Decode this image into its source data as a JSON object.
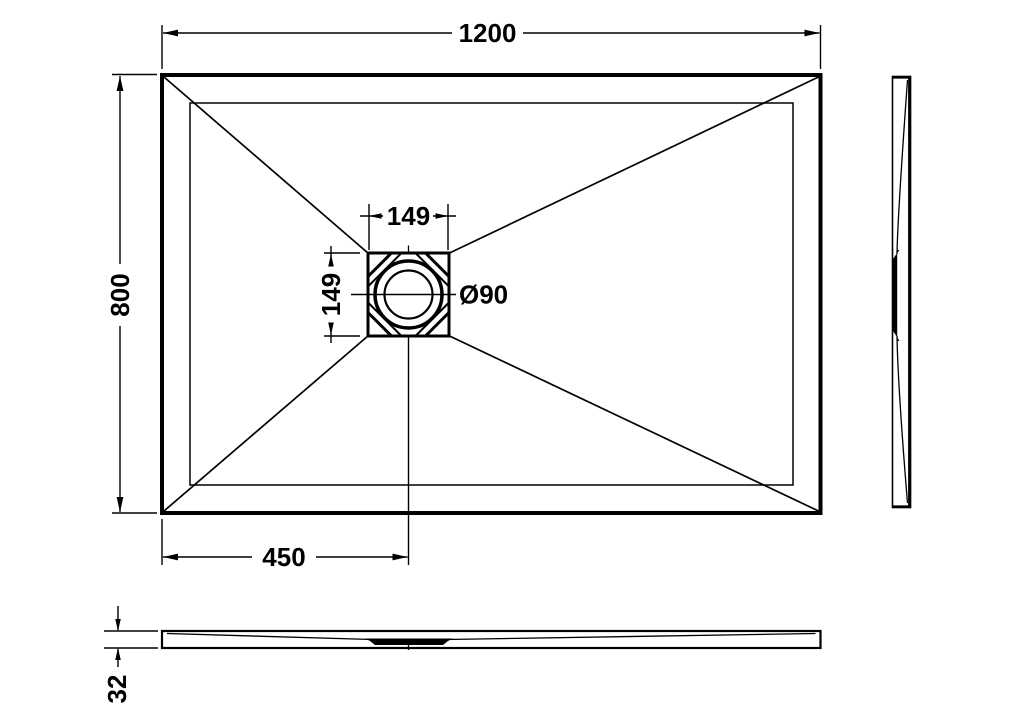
{
  "page": {
    "background": "#ffffff",
    "line_color": "#000000"
  },
  "drawing": {
    "labels": {
      "overall_width": "1200",
      "overall_depth": "800",
      "drain_box_width": "149",
      "drain_box_height": "149",
      "drain_diameter": "Ø90",
      "drain_center_from_left_edge": "450",
      "tray_thickness": "32"
    }
  }
}
